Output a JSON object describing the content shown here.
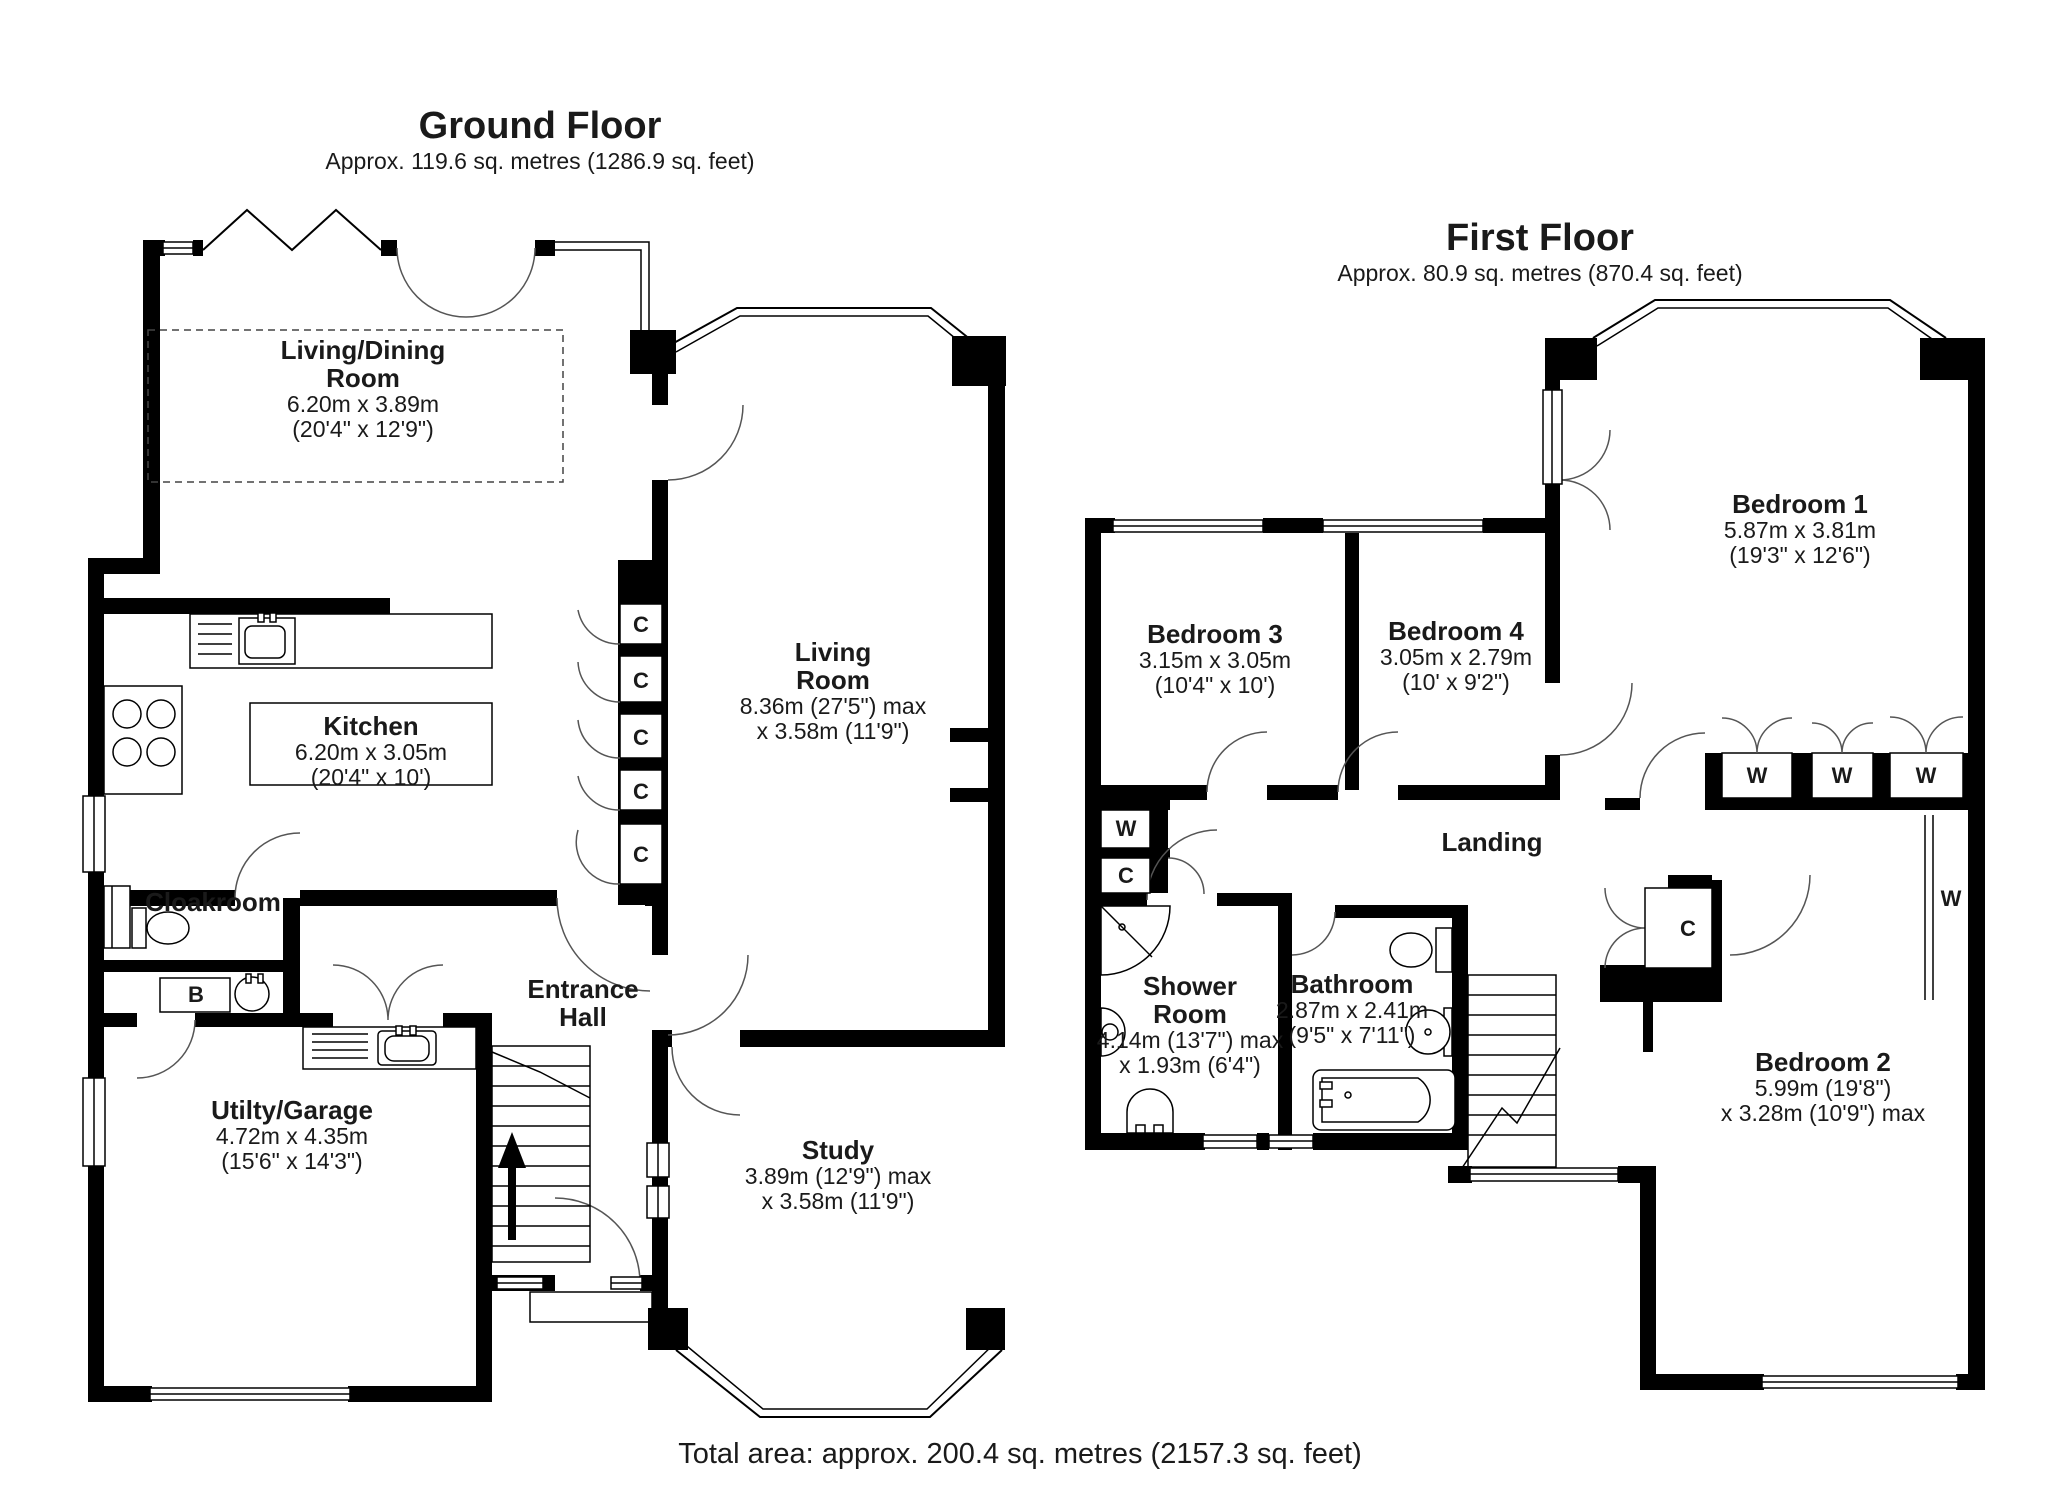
{
  "ground_floor": {
    "title": "Ground Floor",
    "subtitle": "Approx. 119.6 sq. metres (1286.9 sq. feet)",
    "rooms": {
      "living_dining": {
        "name": "Living/Dining Room",
        "metric": "6.20m x 3.89m",
        "imperial": "(20'4\" x 12'9\")"
      },
      "kitchen": {
        "name": "Kitchen",
        "metric": "6.20m x 3.05m",
        "imperial": "(20'4\" x 10')"
      },
      "cloakroom": {
        "name": "Cloakroom"
      },
      "entrance_hall": {
        "name": "Entrance Hall"
      },
      "utility_garage": {
        "name": "Utilty/Garage",
        "metric": "4.72m x 4.35m",
        "imperial": "(15'6\" x 14'3\")"
      },
      "living_room": {
        "name": "Living Room",
        "metric": "8.36m (27'5\") max",
        "imperial": "x 3.58m (11'9\")"
      },
      "study": {
        "name": "Study",
        "metric": "3.89m (12'9\") max",
        "imperial": "x 3.58m (11'9\")"
      }
    }
  },
  "first_floor": {
    "title": "First Floor",
    "subtitle": "Approx. 80.9 sq. metres (870.4 sq. feet)",
    "rooms": {
      "bedroom1": {
        "name": "Bedroom 1",
        "metric": "5.87m x 3.81m",
        "imperial": "(19'3\" x 12'6\")"
      },
      "bedroom2": {
        "name": "Bedroom 2",
        "metric": "5.99m (19'8\")",
        "imperial": "x 3.28m (10'9\") max"
      },
      "bedroom3": {
        "name": "Bedroom 3",
        "metric": "3.15m x 3.05m",
        "imperial": "(10'4\" x 10')"
      },
      "bedroom4": {
        "name": "Bedroom 4",
        "metric": "3.05m x 2.79m",
        "imperial": "(10' x 9'2\")"
      },
      "landing": {
        "name": "Landing"
      },
      "shower_room": {
        "name": "Shower Room",
        "metric": "4.14m (13'7\") max",
        "imperial": "x 1.93m (6'4\")"
      },
      "bathroom": {
        "name": "Bathroom",
        "metric": "2.87m x 2.41m",
        "imperial": "(9'5\" x 7'11\")"
      }
    }
  },
  "markers": {
    "cupboard": "C",
    "wardrobe": "W",
    "boiler": "B"
  },
  "footer": "Total area: approx. 200.4 sq. metres (2157.3 sq. feet)"
}
